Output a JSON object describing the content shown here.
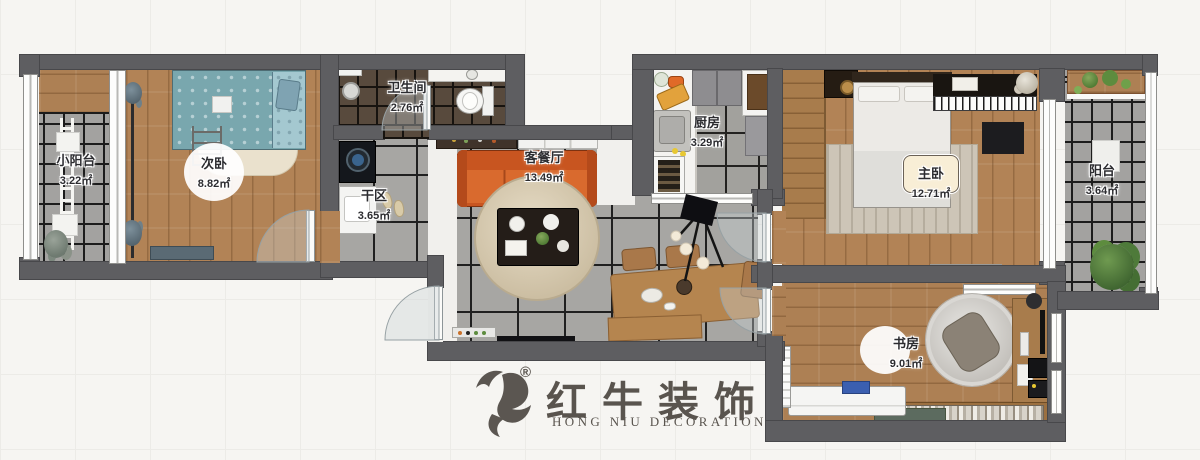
{
  "title": "apartment-floor-plan",
  "rooms": [
    {
      "id": "small-balcony",
      "name": "小阳台",
      "area": "3.22㎡"
    },
    {
      "id": "secondary-bedroom",
      "name": "次卧",
      "area": "8.82㎡"
    },
    {
      "id": "bathroom",
      "name": "卫生间",
      "area": "2.76㎡"
    },
    {
      "id": "dry-area",
      "name": "干区",
      "area": "3.65㎡"
    },
    {
      "id": "living-dining",
      "name": "客餐厅",
      "area": "13.49㎡"
    },
    {
      "id": "kitchen",
      "name": "厨房",
      "area": "3.29㎡"
    },
    {
      "id": "master-bedroom",
      "name": "主卧",
      "area": "12.71㎡"
    },
    {
      "id": "balcony",
      "name": "阳台",
      "area": "3.64㎡"
    },
    {
      "id": "study",
      "name": "书房",
      "area": "9.01㎡"
    }
  ],
  "logo": {
    "brand_cn": "红牛装饰",
    "brand_en": "HONG NIU DECORATION",
    "registered_mark": "®",
    "icon": "bull-logo-icon"
  },
  "colors": {
    "wall": "#5e5e61",
    "wood_floor": "#b28356",
    "gray_tile": "#a7a6a3",
    "bathroom_tile": "#584a3d",
    "sofa_orange": "#cc5a22",
    "bed_blue": "#79a7ae",
    "logo_gray": "#59544e",
    "background": "#f6f5f2"
  }
}
